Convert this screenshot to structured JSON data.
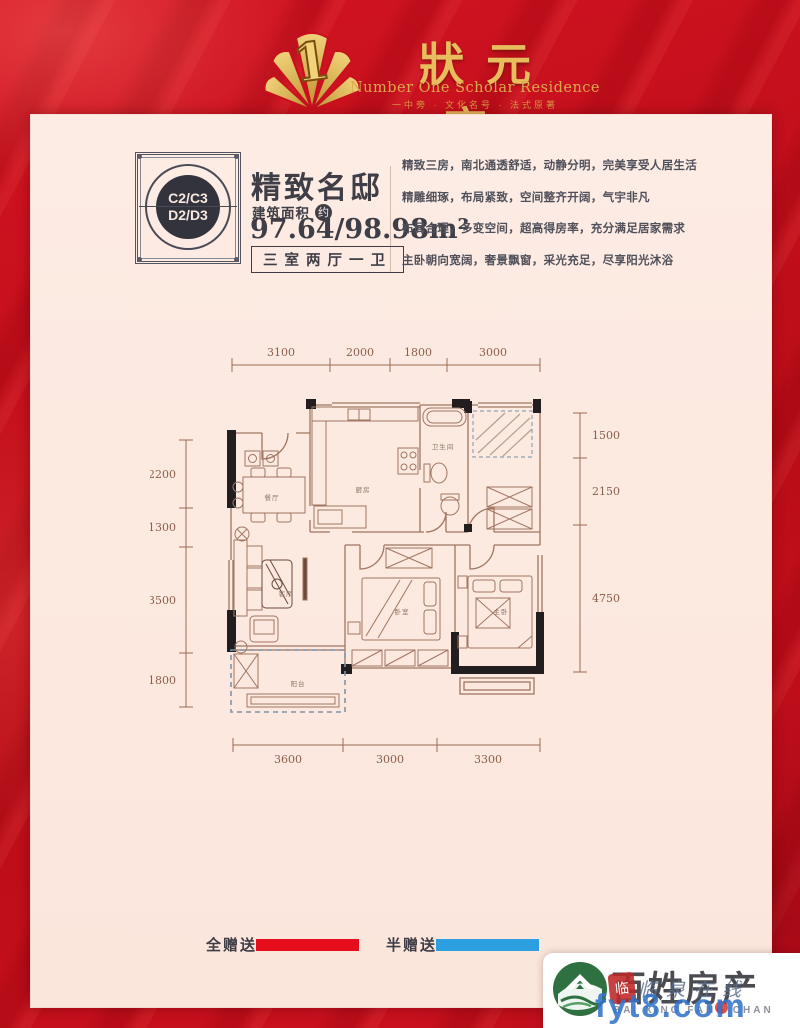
{
  "brand": {
    "name_cn": "狀元府",
    "name_en": "Number One Scholar Residence",
    "tagline": "一中旁 · 文化名号 · 法式原著",
    "logo_numeral": "1"
  },
  "unit": {
    "stamp_top": "C2/C3",
    "stamp_bottom": "D2/D3",
    "title": "精致名邸",
    "area_label": "建筑面积",
    "area_about": "约",
    "area_value": "97.64/98.98m²",
    "layout": "三室两厅一卫"
  },
  "description": {
    "lines": [
      "精致三房，南北通透舒适，动静分明，完美享受人居生活",
      "精雕细琢，布局紧致，空间整齐开阔，气宇非凡",
      "布局合理，多变空间，超高得房率，充分满足居家需求",
      "主卧朝向宽阔，奢景飘窗，采光充足，尽享阳光沐浴"
    ]
  },
  "floorplan": {
    "dims_top": [
      "3100",
      "2000",
      "1800",
      "3000"
    ],
    "dims_left": [
      "2200",
      "1300",
      "3500",
      "1800"
    ],
    "dims_right": [
      "1500",
      "2150",
      "4750"
    ],
    "dims_bottom": [
      "3600",
      "3000",
      "3300"
    ],
    "rooms": [
      {
        "label": "餐厅"
      },
      {
        "label": "厨房"
      },
      {
        "label": "卫生间"
      },
      {
        "label": "客厅"
      },
      {
        "label": "卧室"
      },
      {
        "label": "主卧"
      },
      {
        "label": "阳台"
      }
    ]
  },
  "legend": {
    "full": {
      "label": "全赠送",
      "color": "#e60e1c"
    },
    "half": {
      "label": "半赠送",
      "color": "#2b9fe0"
    }
  },
  "watermark": {
    "agency_cn": "百姓房产",
    "agency_en": "BAI XING FANG CHAN",
    "seal_char": "临",
    "site_name": "临泉在线",
    "site_url": "fyt8.com"
  }
}
